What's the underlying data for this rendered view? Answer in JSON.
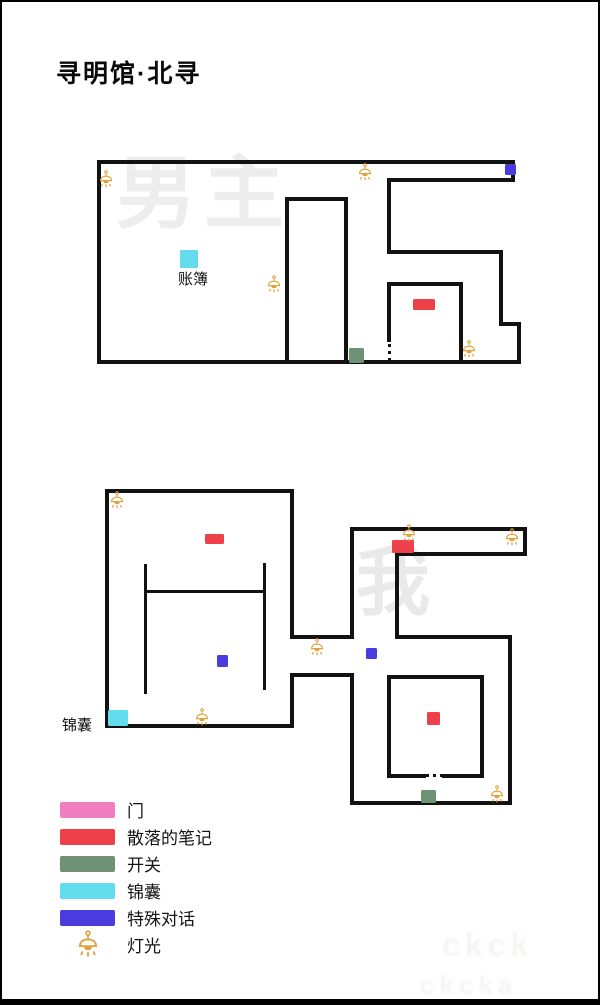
{
  "page": {
    "title": "寻明馆·北寻"
  },
  "colors": {
    "door": "#f07ec1",
    "note": "#ee4049",
    "switch": "#6e9273",
    "bag": "#63dcee",
    "dialog": "#4a3de0",
    "lamp": "#dfa23f",
    "wall": "#121212"
  },
  "legend": {
    "items": [
      {
        "key": "door",
        "label": "门",
        "type": "swatch"
      },
      {
        "key": "note",
        "label": "散落的笔记",
        "type": "swatch"
      },
      {
        "key": "switch",
        "label": "开关",
        "type": "swatch"
      },
      {
        "key": "bag",
        "label": "锦囊",
        "type": "swatch"
      },
      {
        "key": "dialog",
        "label": "特殊对话",
        "type": "swatch"
      },
      {
        "key": "lamp",
        "label": "灯光",
        "type": "lamp"
      }
    ]
  },
  "maps": [
    {
      "name": "map-floor-1",
      "watermark": {
        "text": "男主",
        "x": 114,
        "y": 152,
        "size": 80,
        "color": "#ededed"
      },
      "walls": [
        [
          95,
          158,
          418,
          4
        ],
        [
          509,
          158,
          4,
          22
        ],
        [
          385,
          176,
          128,
          4
        ],
        [
          95,
          158,
          4,
          204
        ],
        [
          95,
          358,
          424,
          4
        ],
        [
          385,
          176,
          4,
          76
        ],
        [
          385,
          248,
          116,
          4
        ],
        [
          497,
          248,
          4,
          76
        ],
        [
          497,
          320,
          22,
          4
        ],
        [
          515,
          320,
          4,
          42
        ],
        [
          283,
          195,
          4,
          167
        ],
        [
          342,
          195,
          4,
          167
        ],
        [
          283,
          195,
          63,
          4
        ],
        [
          385,
          280,
          76,
          4
        ],
        [
          457,
          280,
          4,
          82
        ],
        [
          385,
          284,
          4,
          56
        ]
      ],
      "dotted": [
        [
          386,
          342,
          3,
          16,
          "v"
        ]
      ],
      "markers": [
        {
          "type": "bag",
          "x": 178,
          "y": 248,
          "w": 18,
          "h": 18
        },
        {
          "type": "dialog",
          "x": 503,
          "y": 162,
          "w": 11,
          "h": 11
        },
        {
          "type": "note",
          "x": 411,
          "y": 297,
          "w": 22,
          "h": 11
        },
        {
          "type": "switch",
          "x": 347,
          "y": 346,
          "w": 15,
          "h": 15
        }
      ],
      "lamps": [
        [
          96,
          168
        ],
        [
          355,
          161
        ],
        [
          264,
          273
        ],
        [
          459,
          338
        ]
      ],
      "labels": [
        {
          "name": "ledger-label",
          "text": "账簿",
          "x": 176,
          "y": 266
        }
      ]
    },
    {
      "name": "map-floor-2",
      "watermark": {
        "text": "我",
        "x": 354,
        "y": 544,
        "size": 74,
        "color": "#e9e9e9"
      },
      "walls": [
        [
          103,
          487,
          189,
          4
        ],
        [
          103,
          487,
          4,
          239
        ],
        [
          103,
          722,
          189,
          4
        ],
        [
          288,
          487,
          4,
          150
        ],
        [
          288,
          671,
          4,
          55
        ],
        [
          288,
          633,
          64,
          4
        ],
        [
          288,
          671,
          64,
          4
        ],
        [
          348,
          525,
          4,
          112
        ],
        [
          348,
          671,
          4,
          132
        ],
        [
          348,
          525,
          177,
          4
        ],
        [
          521,
          525,
          4,
          29
        ],
        [
          393,
          550,
          132,
          4
        ],
        [
          393,
          550,
          4,
          87
        ],
        [
          393,
          633,
          117,
          4
        ],
        [
          506,
          633,
          4,
          170
        ],
        [
          348,
          799,
          162,
          4
        ],
        [
          142,
          562,
          3,
          130
        ],
        [
          261,
          561,
          3,
          127
        ],
        [
          142,
          588,
          122,
          3
        ],
        [
          385,
          673,
          97,
          4
        ],
        [
          385,
          673,
          4,
          103
        ],
        [
          478,
          673,
          4,
          103
        ],
        [
          385,
          772,
          39,
          4
        ],
        [
          440,
          772,
          42,
          4
        ]
      ],
      "dotted": [
        [
          424,
          772,
          16,
          3,
          "h"
        ]
      ],
      "markers": [
        {
          "type": "note",
          "x": 203,
          "y": 532,
          "w": 19,
          "h": 10
        },
        {
          "type": "dialog",
          "x": 215,
          "y": 653,
          "w": 11,
          "h": 12
        },
        {
          "type": "bag",
          "x": 106,
          "y": 708,
          "w": 20,
          "h": 16
        },
        {
          "type": "note",
          "x": 390,
          "y": 538,
          "w": 22,
          "h": 13
        },
        {
          "type": "dialog",
          "x": 364,
          "y": 646,
          "w": 11,
          "h": 11
        },
        {
          "type": "note",
          "x": 425,
          "y": 710,
          "w": 13,
          "h": 13
        },
        {
          "type": "switch",
          "x": 419,
          "y": 788,
          "w": 15,
          "h": 13
        }
      ],
      "lamps": [
        [
          107,
          489
        ],
        [
          192,
          706
        ],
        [
          307,
          636
        ],
        [
          399,
          522
        ],
        [
          502,
          526
        ],
        [
          487,
          783
        ]
      ],
      "labels": [
        {
          "name": "pouch-label",
          "text": "锦囊",
          "x": 60,
          "y": 712
        }
      ]
    }
  ],
  "bottom_watermark": {
    "line1": "ckck",
    "line2": "ckcka"
  }
}
